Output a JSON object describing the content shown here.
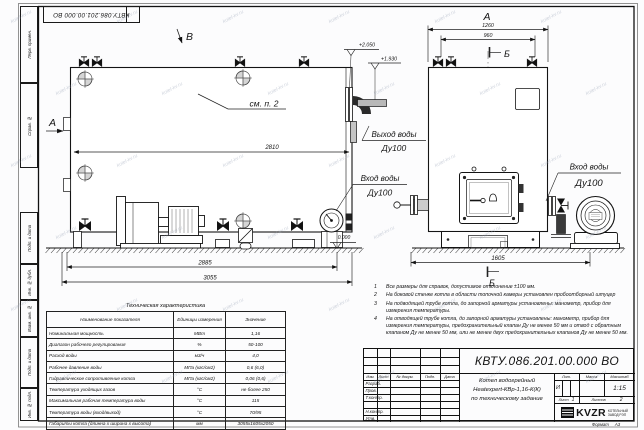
{
  "sheet": {
    "stamp_top": "КВТУ.086.201.00.000  ВО",
    "format_label": "Формат",
    "format_value": "А3",
    "margin_labels": [
      "Перв. примен.",
      "Справ. №",
      "Подп. и дата",
      "Инв. № дубл.",
      "Взам. инв. №",
      "Подп. и дата",
      "Инв. № подл."
    ],
    "watermark_text": "kotel-kv.ru"
  },
  "views": {
    "side": {
      "view_b_label": "В",
      "view_a_label": "А",
      "see_note": "см. п. 2",
      "dim_inner": "2810",
      "dim_mid": "2885",
      "dim_overall": "3055",
      "elev_top": "+2.050",
      "elev_mid": "+1.930",
      "elev_zero": "0.000",
      "outlet_line1": "Выход воды",
      "outlet_line2": "Ду100",
      "inlet_line1": "Вход воды",
      "inlet_line2": "Ду100"
    },
    "front": {
      "view_a_label": "А",
      "section_label_top": "Б",
      "section_label_bottom": "Б",
      "dim_overall": "1260",
      "dim_valves": "960",
      "dim_base": "1605",
      "inlet_line1": "Вход воды",
      "inlet_line2": "Ду100"
    }
  },
  "notes": [
    {
      "n": "1",
      "text": "Все размеры для справок, допустимое отклонение ±100 мм."
    },
    {
      "n": "2",
      "text": "На боковой стенке котла в области топочной камеры установлен пробоотборный штуцер"
    },
    {
      "n": "3",
      "text": "На подводящей трубе котла, до запорной арматуры установлены: манометр, прибор для измерения температуры."
    },
    {
      "n": "4",
      "text": "На отводящей трубе котла, до запорной арматуры установлены: манометр, прибор для измерения температуры, предохранительный клапан Ду не менее 50 мм и отвод с обратным клапаном Ду не менее 50 мм, или не менее двух предохранительных клапанов Ду не менее 50 мм."
    }
  ],
  "spec_table": {
    "title": "Техническая характеристика",
    "headers": [
      "Наименование показателя",
      "Единицы измерения",
      "Значение"
    ],
    "rows": [
      [
        "Номинальная мощность",
        "МВт",
        "1,16"
      ],
      [
        "Диапазон рабочего регулирования",
        "%",
        "50-100"
      ],
      [
        "Расход воды",
        "м3/ч",
        "4,0"
      ],
      [
        "Рабочее давление воды",
        "МПа (кгс/см2)",
        "0,6 (6,0)"
      ],
      [
        "Гидравлическое сопротивление котла",
        "МПа (кгс/см2)",
        "0,06 (0,6)"
      ],
      [
        "Температура уходящих газов",
        "°С",
        "не более 250"
      ],
      [
        "Максимальная рабочая температура воды",
        "°С",
        "115"
      ],
      [
        "Температура воды (вход/выход)",
        "°С",
        "70/95"
      ],
      [
        "Габариты котла (длинна х ширина х высота)",
        "мм",
        "3055х1605х2050"
      ]
    ]
  },
  "title_block": {
    "designation": "КВТУ.086.201.00.000  ВО",
    "name_line1": "Котел водогрейный",
    "name_line2": "Heatexpert-КВр-1,16-К(К)",
    "name_line3": "по техническому задание",
    "header_cols": [
      "Изм.",
      "Лист",
      "№ докум.",
      "Подп.",
      "Дата"
    ],
    "sign_rows": [
      "Разраб.",
      "Пров.",
      "Т.контр.",
      "",
      "Н.контр.",
      "Утв."
    ],
    "lit_label": "Лит.",
    "mass_label": "Масса",
    "scale_label": "Масштаб",
    "lit_value": "И",
    "scale_value": "1:15",
    "sheet_label": "Лист",
    "sheet_value": "1",
    "sheets_label": "Листов",
    "sheets_value": "2",
    "logo_text": "KVZR",
    "company_line1": "КОТЕЛЬНЫЙ",
    "company_line2": "ЗАВОД РЭП"
  }
}
